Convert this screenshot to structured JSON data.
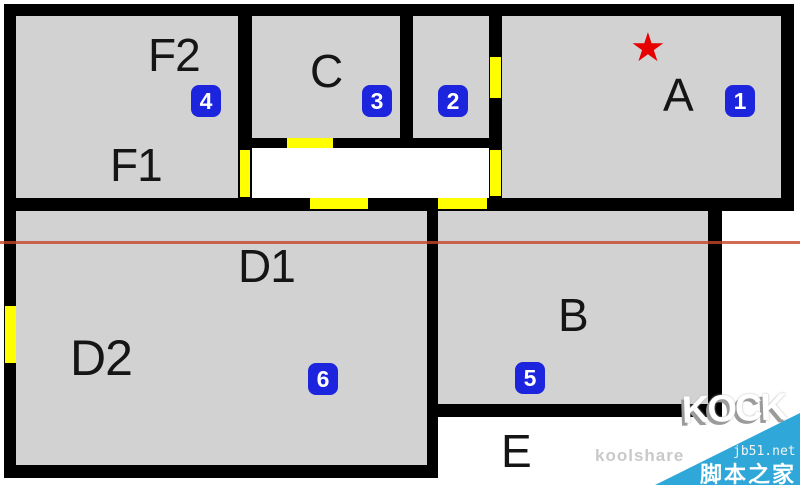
{
  "floor_plan": {
    "room_labels": [
      {
        "id": "f2",
        "text": "F2"
      },
      {
        "id": "f1",
        "text": "F1"
      },
      {
        "id": "c",
        "text": "C"
      },
      {
        "id": "a",
        "text": "A"
      },
      {
        "id": "d1",
        "text": "D1"
      },
      {
        "id": "d2",
        "text": "D2"
      },
      {
        "id": "b",
        "text": "B"
      },
      {
        "id": "e",
        "text": "E"
      }
    ],
    "markers": [
      {
        "number": "1",
        "room": "A"
      },
      {
        "number": "2",
        "room": "small room between C and A"
      },
      {
        "number": "3",
        "room": "C"
      },
      {
        "number": "4",
        "room": "F2"
      },
      {
        "number": "5",
        "room": "B"
      },
      {
        "number": "6",
        "room": "D2"
      }
    ],
    "star": {
      "glyph": "★",
      "room": "A",
      "color": "#e60000"
    },
    "colors": {
      "room_fill": "#d2d2d2",
      "wall": "#000000",
      "door_window_marker": "#ffff00",
      "badge_blue": "#1c24dd",
      "reference_line_red": "#c64628",
      "watermark_triangle_blue": "#2fa7d9"
    }
  },
  "watermarks": {
    "koolshare_text": "koolshare",
    "logo_text": "KOCK",
    "site_url": "jb51.net",
    "site_name": "脚本之家"
  }
}
